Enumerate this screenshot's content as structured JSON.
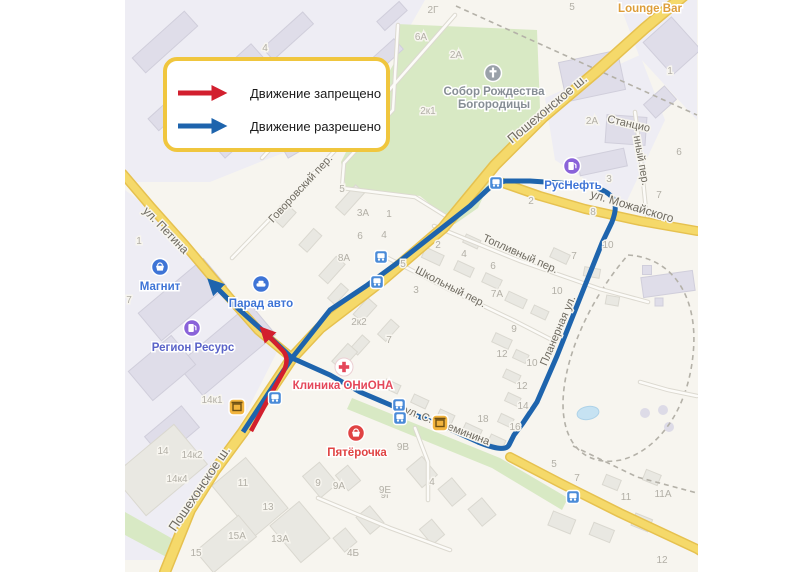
{
  "legend": {
    "items": [
      {
        "id": "prohibited",
        "label": "Движение запрещено",
        "color": "#d21f2e"
      },
      {
        "id": "allowed",
        "label": "Движение разрешено",
        "color": "#1e64ad"
      }
    ],
    "border_color": "#f0c63e"
  },
  "map": {
    "bg": "#f7f5ef",
    "route_allowed_color": "#1e64ad",
    "route_prohibited_color": "#d21f2e",
    "road_color": "#f5d96a",
    "green_color": "#d8e9c4",
    "street_label_color": "#6f6b61",
    "building_number_color": "#b2afa6",
    "street_labels": [
      {
        "text": "Пошехонское ш.",
        "x": 550,
        "y": 112,
        "rot": -40,
        "size": 13
      },
      {
        "text": "Пошехонское ш.",
        "x": 203,
        "y": 491,
        "rot": -56,
        "size": 13
      },
      {
        "text": "ул. Петина",
        "x": 163,
        "y": 233,
        "rot": 46,
        "size": 12
      },
      {
        "text": "ул. Можайского",
        "x": 631,
        "y": 210,
        "rot": 17,
        "size": 12
      },
      {
        "text": "Планерная ул.",
        "x": 561,
        "y": 332,
        "rot": -67,
        "size": 11
      },
      {
        "text": "Школьный пер.",
        "x": 449,
        "y": 290,
        "rot": 27,
        "size": 11
      },
      {
        "text": "Топливный пер.",
        "x": 519,
        "y": 257,
        "rot": 24,
        "size": 11
      },
      {
        "text": "Говоровский пер.",
        "x": 303,
        "y": 191,
        "rot": -47,
        "size": 11
      },
      {
        "text": "ул. С. Преминина",
        "x": 446,
        "y": 429,
        "rot": 21,
        "size": 11
      },
      {
        "text": "Станцио",
        "x": 628,
        "y": 127,
        "rot": 13,
        "size": 11
      },
      {
        "text": "нный пер.",
        "x": 638,
        "y": 161,
        "rot": 80,
        "size": 11
      }
    ],
    "building_numbers": [
      {
        "t": "4",
        "x": 265,
        "y": 51
      },
      {
        "t": "2Г",
        "x": 433,
        "y": 13
      },
      {
        "t": "6А",
        "x": 421,
        "y": 40
      },
      {
        "t": "2А",
        "x": 456,
        "y": 58
      },
      {
        "t": "2к1",
        "x": 428,
        "y": 114
      },
      {
        "t": "5",
        "x": 572,
        "y": 10
      },
      {
        "t": "1",
        "x": 670,
        "y": 74
      },
      {
        "t": "2А",
        "x": 592,
        "y": 124
      },
      {
        "t": "6",
        "x": 679,
        "y": 155
      },
      {
        "t": "3",
        "x": 609,
        "y": 182
      },
      {
        "t": "7",
        "x": 659,
        "y": 198
      },
      {
        "t": "2",
        "x": 531,
        "y": 204
      },
      {
        "t": "8",
        "x": 593,
        "y": 215
      },
      {
        "t": "10",
        "x": 608,
        "y": 248
      },
      {
        "t": "5",
        "x": 342,
        "y": 192
      },
      {
        "t": "3А",
        "x": 363,
        "y": 216
      },
      {
        "t": "1",
        "x": 389,
        "y": 217
      },
      {
        "t": "6",
        "x": 360,
        "y": 239
      },
      {
        "t": "4",
        "x": 384,
        "y": 238
      },
      {
        "t": "8А",
        "x": 344,
        "y": 261
      },
      {
        "t": "5",
        "x": 403,
        "y": 267
      },
      {
        "t": "3",
        "x": 416,
        "y": 293
      },
      {
        "t": "2",
        "x": 438,
        "y": 248
      },
      {
        "t": "4",
        "x": 464,
        "y": 257
      },
      {
        "t": "6",
        "x": 493,
        "y": 269
      },
      {
        "t": "7А",
        "x": 497,
        "y": 297
      },
      {
        "t": "7",
        "x": 574,
        "y": 259
      },
      {
        "t": "10",
        "x": 557,
        "y": 294
      },
      {
        "t": "9",
        "x": 514,
        "y": 332
      },
      {
        "t": "12",
        "x": 502,
        "y": 357
      },
      {
        "t": "10",
        "x": 532,
        "y": 366
      },
      {
        "t": "12",
        "x": 522,
        "y": 389
      },
      {
        "t": "14",
        "x": 523,
        "y": 409
      },
      {
        "t": "16",
        "x": 515,
        "y": 430
      },
      {
        "t": "18",
        "x": 483,
        "y": 422
      },
      {
        "t": "5",
        "x": 554,
        "y": 467
      },
      {
        "t": "2к2",
        "x": 359,
        "y": 325
      },
      {
        "t": "7",
        "x": 389,
        "y": 343
      },
      {
        "t": "1",
        "x": 139,
        "y": 244
      },
      {
        "t": "7",
        "x": 129,
        "y": 303
      },
      {
        "t": "14к1",
        "x": 212,
        "y": 403
      },
      {
        "t": "14",
        "x": 163,
        "y": 454
      },
      {
        "t": "14к2",
        "x": 192,
        "y": 458
      },
      {
        "t": "14к4",
        "x": 177,
        "y": 482
      },
      {
        "t": "11",
        "x": 243,
        "y": 486
      },
      {
        "t": "13",
        "x": 268,
        "y": 510
      },
      {
        "t": "15А",
        "x": 237,
        "y": 539
      },
      {
        "t": "15",
        "x": 196,
        "y": 556
      },
      {
        "t": "13А",
        "x": 280,
        "y": 542
      },
      {
        "t": "9",
        "x": 318,
        "y": 486
      },
      {
        "t": "9А",
        "x": 339,
        "y": 489
      },
      {
        "t": "9Г",
        "x": 386,
        "y": 498
      },
      {
        "t": "4Б",
        "x": 353,
        "y": 556
      },
      {
        "t": "9В",
        "x": 403,
        "y": 450
      },
      {
        "t": "9Е",
        "x": 385,
        "y": 493
      },
      {
        "t": "4",
        "x": 432,
        "y": 485
      },
      {
        "t": "7",
        "x": 577,
        "y": 481
      },
      {
        "t": "11",
        "x": 626,
        "y": 500
      },
      {
        "t": "11А",
        "x": 663,
        "y": 497
      },
      {
        "t": "12",
        "x": 662,
        "y": 563
      }
    ],
    "pois": [
      {
        "name": "magnit",
        "type": "grocery",
        "label": "Магнит",
        "icon_bg": "#3e74d6",
        "text_color": "#3e74d6",
        "ix": 160,
        "iy": 267,
        "lx": 160,
        "ly": 290
      },
      {
        "name": "parad-avto",
        "type": "car",
        "label": "Парад авто",
        "icon_bg": "#3e74d6",
        "text_color": "#3e74d6",
        "ix": 261,
        "iy": 284,
        "lx": 261,
        "ly": 307
      },
      {
        "name": "region-resurs",
        "type": "fuel",
        "label": "Регион Ресурс",
        "icon_bg": "#8a63d9",
        "text_color": "#5a63c8",
        "ix": 192,
        "iy": 328,
        "lx": 193,
        "ly": 351
      },
      {
        "name": "rusneft",
        "type": "fuel",
        "label": "РусНефть",
        "icon_bg": "#8a63d9",
        "text_color": "#3e74d6",
        "ix": 572,
        "iy": 166,
        "lx": 573,
        "ly": 189
      },
      {
        "name": "klinika-oniona",
        "type": "medical",
        "label": "Клиника ОНиОНА",
        "icon_bg": "#ffffff",
        "text_color": "#e4475a",
        "ix": 344,
        "iy": 367,
        "lx": 343,
        "ly": 389
      },
      {
        "name": "pyaterochka",
        "type": "grocery",
        "label": "Пятёрочка",
        "icon_bg": "#e04343",
        "text_color": "#e04343",
        "ix": 356,
        "iy": 433,
        "lx": 357,
        "ly": 456
      },
      {
        "name": "sobor",
        "type": "church",
        "label": "Собор Рождества",
        "label2": "Богородицы",
        "icon_bg": "#9aa1a9",
        "text_color": "#878e95",
        "ix": 493,
        "iy": 73,
        "lx": 494,
        "ly": 95
      },
      {
        "name": "lounge-bar",
        "type": "bar",
        "label": "Lounge Bar",
        "text_color": "#dd9d3a",
        "lx": 650,
        "ly": 12
      }
    ],
    "landmark_icons": [
      {
        "x": 237,
        "y": 407
      },
      {
        "x": 440,
        "y": 423
      }
    ],
    "bus_stops": [
      [
        381,
        257
      ],
      [
        377,
        282
      ],
      [
        496,
        183
      ],
      [
        275,
        398
      ],
      [
        399,
        405
      ],
      [
        400,
        418
      ],
      [
        573,
        497
      ]
    ],
    "routes": {
      "allowed_path": "M 243,432 L 268,394 L 292,358 L 330,375 L 360,392 L 400,409 L 445,427 L 478,442 Q 505,453 509,445 L 514,435 L 523,423 L 537,402 L 557,356 L 584,288 L 602,243 L 612,222 Q 619,204 611,196 Q 603,188 585,185 L 560,183 L 530,181 L 505,181 Q 494,183 486,191 L 470,206 L 433,235 L 400,261 L 366,286 L 330,310 L 292,358 L 262,330 L 232,303 L 212,283",
      "prohibited_path": "M 251,431 L 265,405 L 281,376 Q 291,360 283,351 L 264,331"
    }
  }
}
